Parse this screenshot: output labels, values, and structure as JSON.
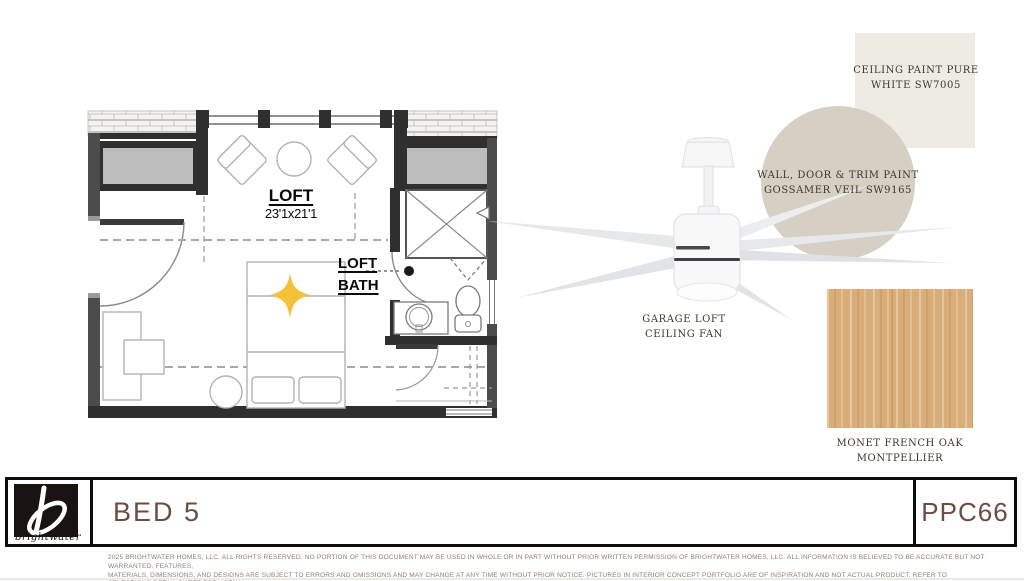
{
  "board": {
    "plan": {
      "room_name": "LOFT",
      "room_dims": "23'1x21'1",
      "bath_name": "LOFT BATH"
    },
    "fan_caption": "GARAGE LOFT CEILING FAN",
    "finishes": {
      "ceiling_paint": {
        "label": "CEILING PAINT PURE WHITE SW7005",
        "color": "#edebe4"
      },
      "wall_paint": {
        "label": "WALL, DOOR & TRIM PAINT GOSSAMER VEIL SW9165",
        "color": "#d5d0c3"
      },
      "flooring": {
        "label": "MONET FRENCH OAK MONTPELLIER",
        "color": "#d9ad79"
      }
    },
    "accent_star_color": "#f4c238"
  },
  "title_block": {
    "room_title": "BED 5",
    "plan_code": "PPC66",
    "brand_name": "brightwater",
    "text_color": "#6d4c41"
  },
  "disclaimer": {
    "line1": "2025 BRIGHTWATER HOMES, LLC. ALL RIGHTS RESERVED. NO PORTION OF THIS DOCUMENT MAY BE USED IN WHOLE OR IN PART WITHOUT PRIOR WRITTEN PERMISSION OF BRIGHTWATER HOMES, LLC. ALL INFORMATION IS BELIEVED TO BE ACCURATE BUT NOT WARRANTED. FEATURES,",
    "line2": "MATERIALS, DIMENSIONS, AND DESIGNS ARE SUBJECT TO ERRORS AND OMISSIONS AND MAY CHANGE AT ANY TIME WITHOUT PRIOR NOTICE. PICTURES IN INTERIOR CONCEPT PORTFOLIO ARE OF INSPIRATION AND NOT ACTUAL PRODUCT. REFER TO SELECTIONS DETAIL SHEET FOR ACTUAL",
    "line3": "HOME SPECIFICATIONS. ARTWORK, FURNITURE, AND ACCESSORIES ARE NOT INCLUDED."
  }
}
